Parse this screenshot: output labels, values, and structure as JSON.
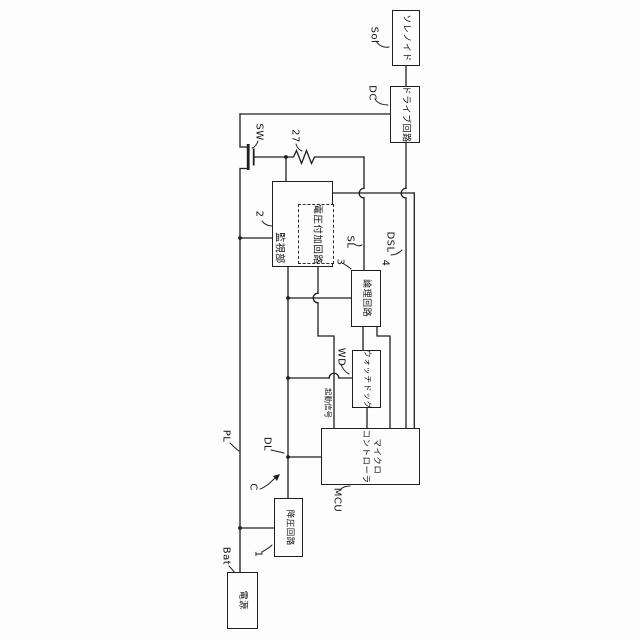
{
  "figure": {
    "type": "patent-block-diagram",
    "orientation": "rotated-90-clockwise-text",
    "background": "#fdfdfd",
    "line_color": "#1f1f1f"
  },
  "blocks": {
    "solenoid": "ソレノイド",
    "drive": "ドライブ回路",
    "monitor": "監視部",
    "voltage_add": "電圧付加回路",
    "logic": "論理回路",
    "watchdog": "ウォッチドッグ",
    "mcu": "マイクロ\nコントローラ",
    "buck": "降圧回路",
    "power": "電源"
  },
  "refs": {
    "sol": "Sol",
    "dc": "DC",
    "sw": "SW",
    "r27": "27",
    "monitor": "2",
    "sl": "SL",
    "logic_num": "3",
    "dsl": "DSL",
    "dsl_num": "4",
    "wd": "WD",
    "start_signal": "起動信号",
    "mcu": "MCU",
    "pl": "PL",
    "dl": "DL",
    "c": "C",
    "buck": "1",
    "bat": "Bat"
  }
}
